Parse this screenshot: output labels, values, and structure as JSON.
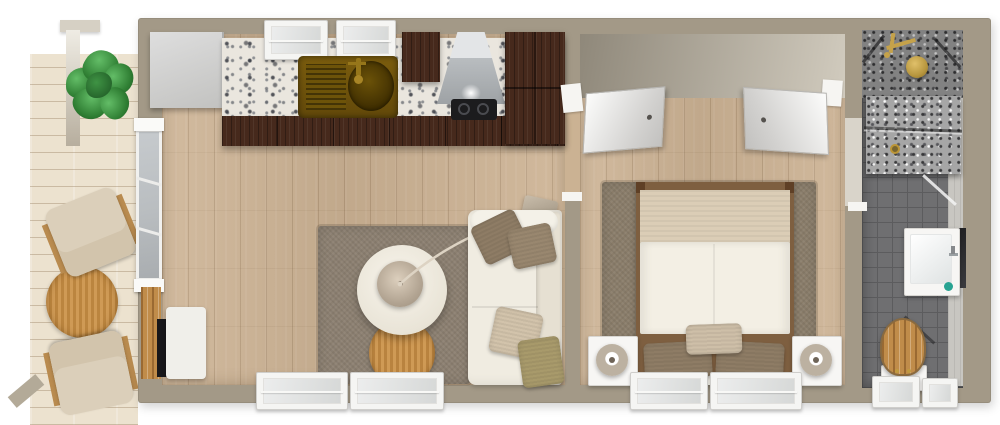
{
  "scene": {
    "kind": "3D floor plan, top-down render of a one-bedroom tiny home with deck",
    "rooms": [
      {
        "name": "deck",
        "items": [
          "pergola-post",
          "pergola-post",
          "potted-plant",
          "round-wood-table",
          "deck-chair",
          "deck-chair"
        ]
      },
      {
        "name": "kitchen-living-room",
        "items": [
          "refrigerator",
          "marble-countertop",
          "kitchen-window",
          "kitchen-window",
          "brass-sink",
          "wall-cabinet",
          "range-hood",
          "cooktop",
          "tall-cabinet",
          "base-cabinets",
          "sliding-glass-door",
          "tv-backboard",
          "television",
          "media-bench",
          "area-rug",
          "round-coffee-table",
          "arc-floor-lamp",
          "round-side-table",
          "sofa",
          "throw-pillow",
          "throw-pillow",
          "throw-pillow",
          "throw-pillow",
          "window",
          "window"
        ]
      },
      {
        "name": "bedroom",
        "items": [
          "entry-door",
          "bathroom-door",
          "area-rug",
          "double-bed",
          "blanket",
          "duvet",
          "pillow",
          "pillow",
          "pillow",
          "nightstand",
          "table-lamp",
          "nightstand",
          "table-lamp",
          "window",
          "window"
        ]
      },
      {
        "name": "bathroom",
        "items": [
          "walk-in-shower",
          "brass-shower-fixture",
          "glass-shower-door",
          "floor-drain",
          "vanity-sink",
          "faucet",
          "soap-dish",
          "mirror",
          "toilet",
          "window",
          "window"
        ]
      }
    ]
  },
  "palette": {
    "wall": "#a39987",
    "wallface-dark": "#8f887a",
    "wallface-light": "#d1cbbe",
    "oak": "#cdb394",
    "deck": "#ece2cf",
    "tile": "#6f6f71",
    "tile-grout": "#5c5c5e",
    "marble": "#eae6de",
    "walnut": "#46291c",
    "wood": "#c08c4a",
    "brass": "#b8973f",
    "sink-brass": "#6f5408",
    "hood-steel": "#b9bdc0",
    "rug-living": "#8c8071",
    "rug-bedroom": "#8a7d6a",
    "cream": "#f0ece1",
    "blanket": "#dbcdb6",
    "pillow-brown": "#8e7c65",
    "pillow-beige": "#d2c3ab",
    "pillow-olive": "#a89a6b",
    "lamp-taupe": "#b2a492",
    "teal": "#28a392",
    "glass": "#b9bdc0",
    "tv-black": "#17171a",
    "plant": "#2e7d32"
  }
}
